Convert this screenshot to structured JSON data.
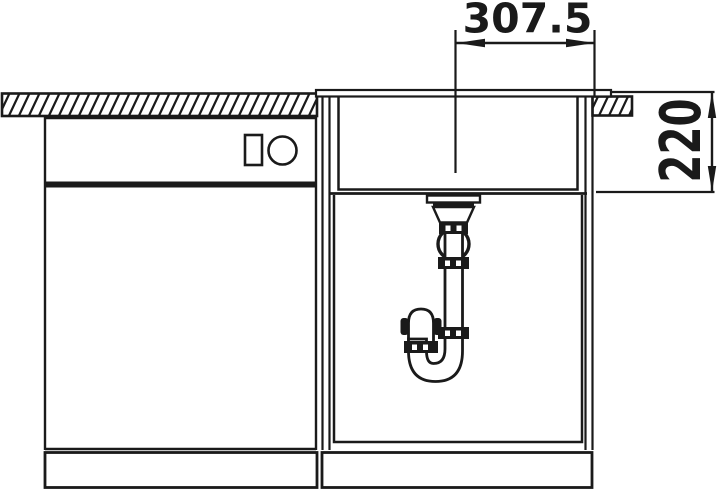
{
  "drawing": {
    "type": "sink-installation-cross-section",
    "dimensions": {
      "width_mm": "307.5",
      "depth_mm": "220"
    },
    "colors": {
      "line": "#1a1a1a",
      "background": "#ffffff"
    },
    "components": {
      "countertop": "hatched-worktop-section",
      "left_unit": "base-cabinet-with-drawer",
      "sink": "single-bowl-sink",
      "drain": "strainer-ball-joint-space-saver-trap"
    }
  }
}
